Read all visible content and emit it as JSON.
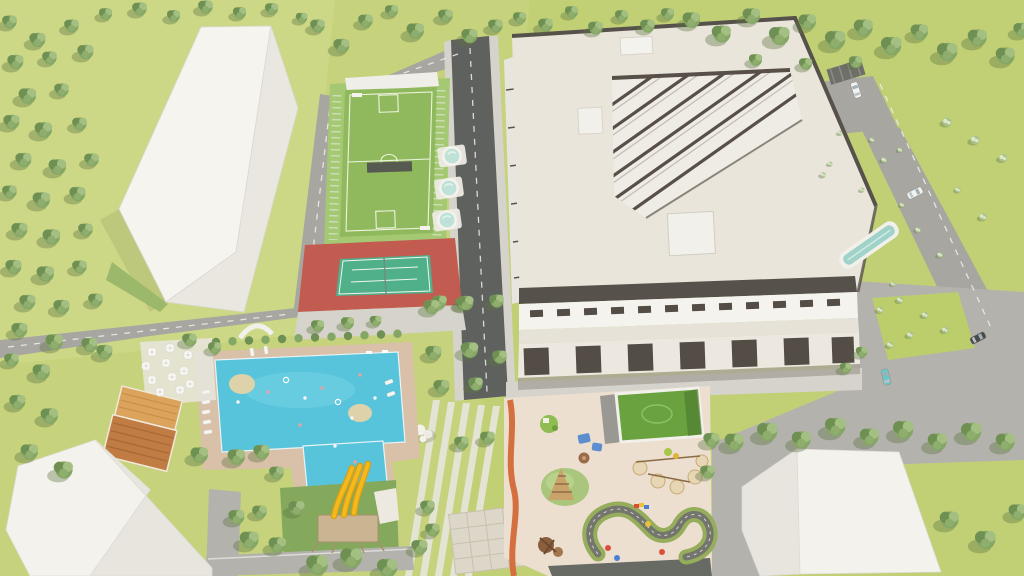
{
  "scene": {
    "description": "aerial-3d-render-residential-complex",
    "elements": [
      "orchard-field",
      "white-tower-building",
      "multisport-court",
      "spa-pools",
      "tennis-court",
      "apartment-complex",
      "rooftop-lap-pool",
      "swimming-pool",
      "water-slides",
      "cafe-terrace",
      "orange-roof-building",
      "playground",
      "kart-track",
      "roof-court",
      "white-hip-roof-building",
      "white-corner-building",
      "access-roads",
      "parking-cars"
    ],
    "colors": {
      "grass": "#c6d27c",
      "grass_field": "#cfd989",
      "grass_deep": "#bccd6c",
      "lawn_dark": "#84a95d",
      "tree_dark": "#6f9053",
      "tree_mid": "#85a765",
      "tree_mid2": "#8fae6e",
      "tree_light": "#a3bf82",
      "tree_shadow": "#5c7442",
      "shrub": "#a9c08b",
      "shrub_light": "#dde8cc",
      "road": "#a8a6a1",
      "road_dark": "#5f615e",
      "sidewalk": "#d6d3cc",
      "plaza": "#b4b2ad",
      "deck": "#d8c0a9",
      "pool": "#57c4dc",
      "pool_light": "#8adcec",
      "island_sand": "#ddd2a9",
      "roof_cream": "#eae5da",
      "roof_trim": "#57514b",
      "facade_white": "#f5f3ee",
      "facade_cream": "#e7e2d8",
      "facade_dark": "#534d46",
      "tower_face": "#efece5",
      "court_green": "#8fb95c",
      "court_pad": "#a5c873",
      "court_line": "#eef4de",
      "fence": "#cfe0bb",
      "tennis_red": "#c25b50",
      "tennis_green": "#4fb08a",
      "spa": "#bfe2d8",
      "lap_pool": "#9fd2c8",
      "slide_yellow": "#f4b91d",
      "slide_dark": "#d99e12",
      "platform_wood": "#cbb492",
      "sand": "#ecdfcf",
      "sand_circle": "#e6d6b4",
      "mound": "#a9c67c",
      "hedge": "#96ad5c",
      "track_dark": "#74766e",
      "wall_orange": "#d4703f",
      "orange_roof": "#dba35c",
      "orange_roof_dark": "#c07c43",
      "white_roof": "#f4f2ed",
      "white_roof_shade": "#e8e5df",
      "car_white": "#f2f2f2",
      "car_teal": "#6fc6c9",
      "car_dark": "#4a4a4a"
    },
    "trees": {
      "orchard": [
        [
          10,
          22,
          1
        ],
        [
          38,
          40,
          1.1
        ],
        [
          72,
          26,
          1
        ],
        [
          106,
          14,
          0.9
        ],
        [
          140,
          9,
          1
        ],
        [
          174,
          16,
          0.9
        ],
        [
          206,
          7,
          1
        ],
        [
          240,
          13,
          0.9
        ],
        [
          272,
          9,
          0.9
        ],
        [
          302,
          18,
          0.8
        ],
        [
          16,
          62,
          1.1
        ],
        [
          50,
          58,
          1
        ],
        [
          86,
          52,
          1.1
        ],
        [
          28,
          96,
          1.2
        ],
        [
          62,
          90,
          1
        ],
        [
          12,
          122,
          1.1
        ],
        [
          44,
          130,
          1.2
        ],
        [
          80,
          124,
          1
        ],
        [
          24,
          160,
          1.1
        ],
        [
          58,
          167,
          1.2
        ],
        [
          92,
          160,
          1
        ],
        [
          10,
          192,
          1
        ],
        [
          42,
          200,
          1.2
        ],
        [
          78,
          194,
          1.1
        ],
        [
          20,
          230,
          1.1
        ],
        [
          52,
          237,
          1.2
        ],
        [
          86,
          230,
          1
        ],
        [
          14,
          267,
          1.1
        ],
        [
          46,
          274,
          1.2
        ],
        [
          80,
          267,
          1
        ],
        [
          28,
          302,
          1.1
        ],
        [
          62,
          307,
          1.1
        ],
        [
          96,
          300,
          1
        ],
        [
          90,
          345,
          1.1
        ]
      ],
      "left_edge": [
        [
          20,
          330,
          1.1
        ],
        [
          55,
          342,
          1.2
        ],
        [
          12,
          360,
          1
        ],
        [
          42,
          372,
          1.2
        ],
        [
          105,
          352,
          1.1
        ],
        [
          18,
          402,
          1.1
        ],
        [
          50,
          416,
          1.2
        ],
        [
          30,
          452,
          1.2
        ],
        [
          64,
          470,
          1.3
        ]
      ],
      "top_row": [
        [
          318,
          26,
          1
        ],
        [
          342,
          46,
          1.1
        ],
        [
          366,
          21,
          1
        ],
        [
          392,
          11,
          0.9
        ],
        [
          416,
          31,
          1.2
        ],
        [
          446,
          16,
          1
        ],
        [
          470,
          36,
          1.1
        ],
        [
          496,
          26,
          1
        ],
        [
          520,
          18,
          0.9
        ],
        [
          546,
          25,
          1
        ],
        [
          572,
          12,
          0.9
        ],
        [
          596,
          28,
          1
        ],
        [
          622,
          16,
          0.9
        ],
        [
          648,
          26,
          1
        ],
        [
          668,
          14,
          0.9
        ]
      ],
      "top_right_row": [
        [
          692,
          20,
          1.2
        ],
        [
          722,
          34,
          1.3
        ],
        [
          752,
          16,
          1.2
        ],
        [
          780,
          36,
          1.4
        ],
        [
          808,
          22,
          1.2
        ],
        [
          836,
          40,
          1.4
        ],
        [
          864,
          28,
          1.3
        ],
        [
          892,
          46,
          1.4
        ],
        [
          920,
          32,
          1.2
        ],
        [
          948,
          52,
          1.4
        ],
        [
          978,
          38,
          1.3
        ],
        [
          1006,
          56,
          1.3
        ],
        [
          1022,
          30,
          1.1
        ],
        [
          756,
          60,
          0.9
        ],
        [
          806,
          64,
          0.9
        ],
        [
          856,
          62,
          0.9
        ]
      ],
      "right_scatter": [
        [
          840,
          133,
          0.6
        ],
        [
          872,
          140,
          0.6
        ],
        [
          884,
          160,
          0.7
        ],
        [
          830,
          164,
          0.6
        ],
        [
          900,
          150,
          0.6
        ],
        [
          947,
          122,
          1.1
        ],
        [
          975,
          140,
          1.1
        ],
        [
          1003,
          158,
          1
        ],
        [
          983,
          217,
          0.9
        ],
        [
          958,
          190,
          0.7
        ],
        [
          918,
          230,
          0.7
        ],
        [
          940,
          255,
          0.7
        ],
        [
          902,
          205,
          0.6
        ],
        [
          862,
          190,
          0.6
        ],
        [
          823,
          175,
          0.7
        ],
        [
          893,
          284,
          0.6
        ]
      ],
      "tennis_row": [
        [
          318,
          326,
          0.9
        ],
        [
          348,
          323,
          0.9
        ],
        [
          376,
          321,
          0.8
        ],
        [
          440,
          302,
          1
        ],
        [
          462,
          304,
          0.9
        ]
      ],
      "street": [
        [
          432,
          307,
          1.1
        ],
        [
          466,
          303,
          1.1
        ],
        [
          497,
          301,
          1
        ],
        [
          434,
          353,
          1.1
        ],
        [
          470,
          350,
          1.2
        ],
        [
          500,
          357,
          1
        ],
        [
          442,
          387,
          1.1
        ],
        [
          476,
          384,
          1
        ]
      ],
      "pool_area": [
        [
          190,
          340,
          1
        ],
        [
          215,
          348,
          0.9
        ],
        [
          200,
          455,
          1.2
        ],
        [
          237,
          457,
          1.2
        ],
        [
          262,
          452,
          1.1
        ],
        [
          277,
          473,
          1
        ],
        [
          297,
          508,
          1.1
        ],
        [
          260,
          512,
          1
        ],
        [
          237,
          517,
          1.1
        ],
        [
          250,
          540,
          1.3
        ],
        [
          278,
          545,
          1.2
        ],
        [
          462,
          443,
          1
        ],
        [
          488,
          438,
          1
        ],
        [
          428,
          507,
          1
        ],
        [
          433,
          530,
          1
        ],
        [
          420,
          547,
          1.1
        ]
      ],
      "bottom_center": [
        [
          318,
          565,
          1.5
        ],
        [
          352,
          558,
          1.5
        ],
        [
          388,
          568,
          1.4
        ]
      ],
      "playground_edge": [
        [
          712,
          440,
          1.1
        ],
        [
          708,
          472,
          1
        ],
        [
          862,
          352,
          0.8
        ],
        [
          846,
          368,
          0.8
        ]
      ],
      "bottom_right_row": [
        [
          735,
          442,
          1.3
        ],
        [
          768,
          432,
          1.4
        ],
        [
          802,
          440,
          1.3
        ],
        [
          836,
          427,
          1.4
        ],
        [
          870,
          437,
          1.3
        ],
        [
          904,
          430,
          1.4
        ],
        [
          938,
          442,
          1.3
        ],
        [
          972,
          432,
          1.4
        ],
        [
          1006,
          442,
          1.3
        ],
        [
          950,
          520,
          1.3
        ],
        [
          986,
          540,
          1.4
        ],
        [
          1018,
          512,
          1.2
        ]
      ]
    },
    "parasols": [
      [
        152,
        352
      ],
      [
        170,
        348
      ],
      [
        188,
        355
      ],
      [
        146,
        366
      ],
      [
        166,
        363
      ],
      [
        184,
        371
      ],
      [
        152,
        380
      ],
      [
        172,
        377
      ],
      [
        190,
        384
      ],
      [
        160,
        392
      ],
      [
        180,
        390
      ]
    ],
    "loungers": [
      [
        206,
        392,
        80
      ],
      [
        206,
        402,
        80
      ],
      [
        206,
        412,
        80
      ],
      [
        207,
        422,
        80
      ],
      [
        208,
        432,
        80
      ],
      [
        252,
        352,
        -8
      ],
      [
        266,
        350,
        -8
      ],
      [
        389,
        382,
        70
      ],
      [
        391,
        394,
        70
      ]
    ],
    "spa_pools": [
      [
        452,
        156
      ],
      [
        449,
        188
      ],
      [
        447,
        220
      ]
    ],
    "cars": [
      {
        "x": 856,
        "y": 90,
        "r": -18,
        "kind": "car_white"
      },
      {
        "x": 915,
        "y": 193,
        "r": 63,
        "kind": "car_white"
      },
      {
        "x": 886,
        "y": 377,
        "r": -14,
        "kind": "car_teal"
      },
      {
        "x": 978,
        "y": 338,
        "r": 63,
        "kind": "car_dark"
      }
    ],
    "pool_people": [
      [
        268,
        392,
        "p"
      ],
      [
        286,
        380,
        "f"
      ],
      [
        305,
        398,
        "w"
      ],
      [
        322,
        388,
        "p"
      ],
      [
        338,
        402,
        "f"
      ],
      [
        352,
        418,
        "w"
      ],
      [
        300,
        425,
        "p"
      ],
      [
        335,
        446,
        "w"
      ],
      [
        355,
        462,
        "p"
      ],
      [
        238,
        402,
        "w"
      ],
      [
        360,
        375,
        "p"
      ],
      [
        375,
        398,
        "w"
      ]
    ],
    "hedgerow": {
      "x0": 216,
      "y0": 342,
      "dx": 16.5,
      "dy": -0.75,
      "count": 12
    }
  }
}
